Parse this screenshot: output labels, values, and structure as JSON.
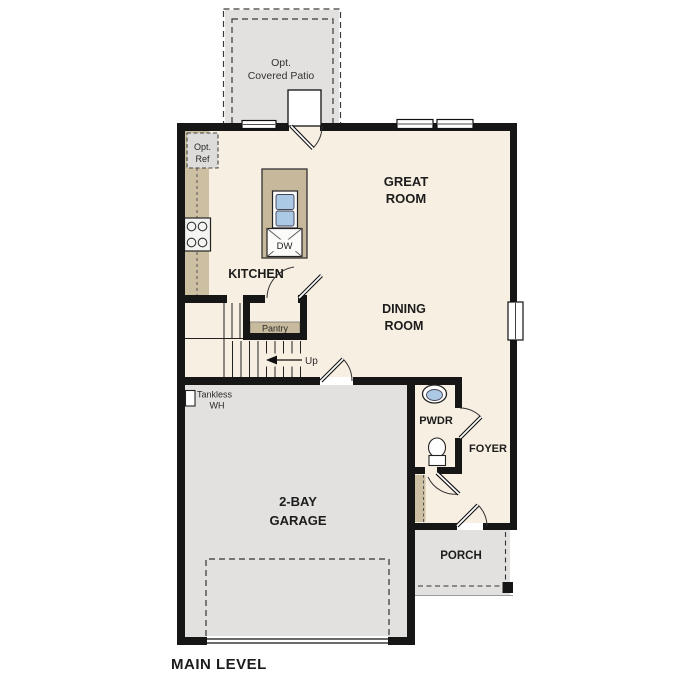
{
  "floor_plan": {
    "title": "MAIN LEVEL",
    "colors": {
      "wall": "#161616",
      "interior": "#f7efe1",
      "concrete": "#e2e1df",
      "counter": "#cdbfa2",
      "island": "#c7b89b",
      "shelf": "#c8ba9c",
      "sink_blue": "#abc8e4",
      "optional_fill": "#dddcda",
      "fixture_white": "#fbfbfa"
    },
    "labels": {
      "patio_1": "Opt.",
      "patio_2": "Covered Patio",
      "ref_1": "Opt.",
      "ref_2": "Ref",
      "great_room_1": "GREAT",
      "great_room_2": "ROOM",
      "kitchen": "KITCHEN",
      "dining_1": "DINING",
      "dining_2": "ROOM",
      "pantry": "Pantry",
      "up": "Up",
      "dishwasher": "DW",
      "tankless_1": "Tankless",
      "tankless_2": "WH",
      "pwdr": "PWDR",
      "foyer": "FOYER",
      "garage_1": "2-BAY",
      "garage_2": "GARAGE",
      "porch": "PORCH",
      "main_level": "MAIN LEVEL"
    }
  }
}
